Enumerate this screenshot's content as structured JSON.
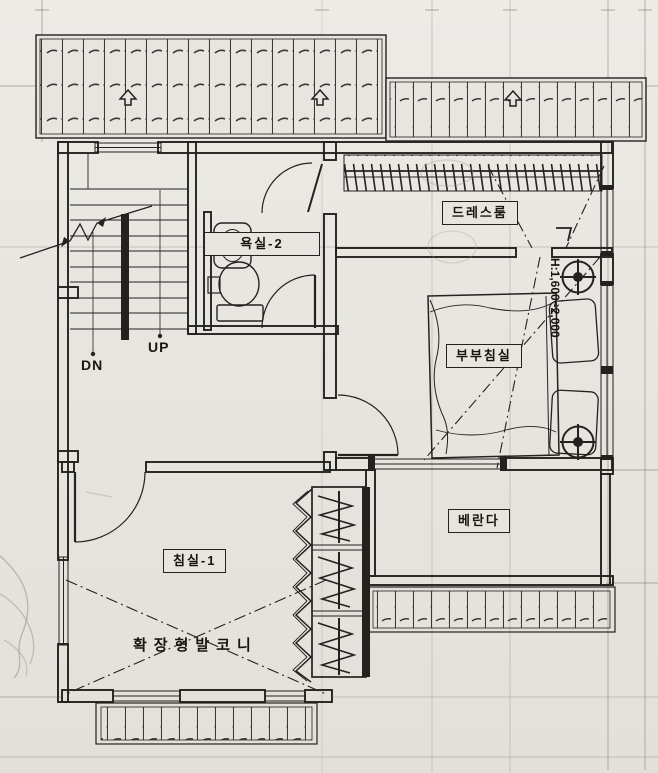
{
  "labels": {
    "dressroom": "드레스룸",
    "bathroom2": "욕실-2",
    "master_bedroom": "부부침실",
    "veranda": "베란다",
    "bedroom1": "침실-1",
    "extended_balcony": "확장형발코니",
    "stairs_up": "UP",
    "stairs_down": "DN",
    "slope_annotation": "H:1,600~2,000"
  },
  "colors": {
    "paper": "#e8e5e0",
    "ink": "#23221f",
    "pencil": "#9a958c"
  }
}
